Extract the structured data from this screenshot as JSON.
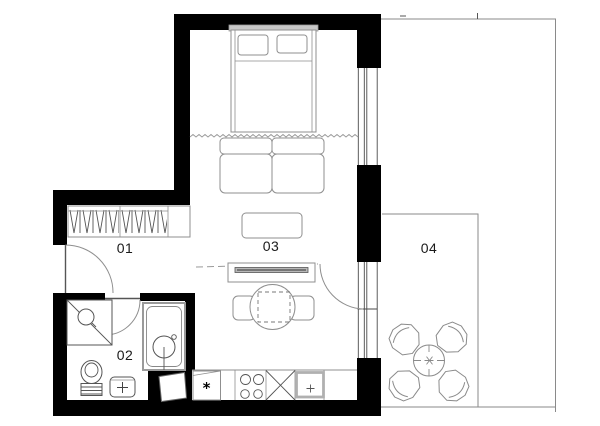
{
  "rooms": [
    {
      "label": "01"
    },
    {
      "label": "02"
    },
    {
      "label": "03"
    },
    {
      "label": "04"
    }
  ],
  "symbols": {
    "appliance_star": "*"
  },
  "colors": {
    "wall": "#000000",
    "furniture_outline": "#8f8f8f",
    "fixture_outline": "#555555",
    "terrace_outline": "#8a8a8a",
    "label_text": "#1a1a1a",
    "headboard_fill": "#c8c8c8",
    "tv_fill": "#b8b8b8"
  }
}
